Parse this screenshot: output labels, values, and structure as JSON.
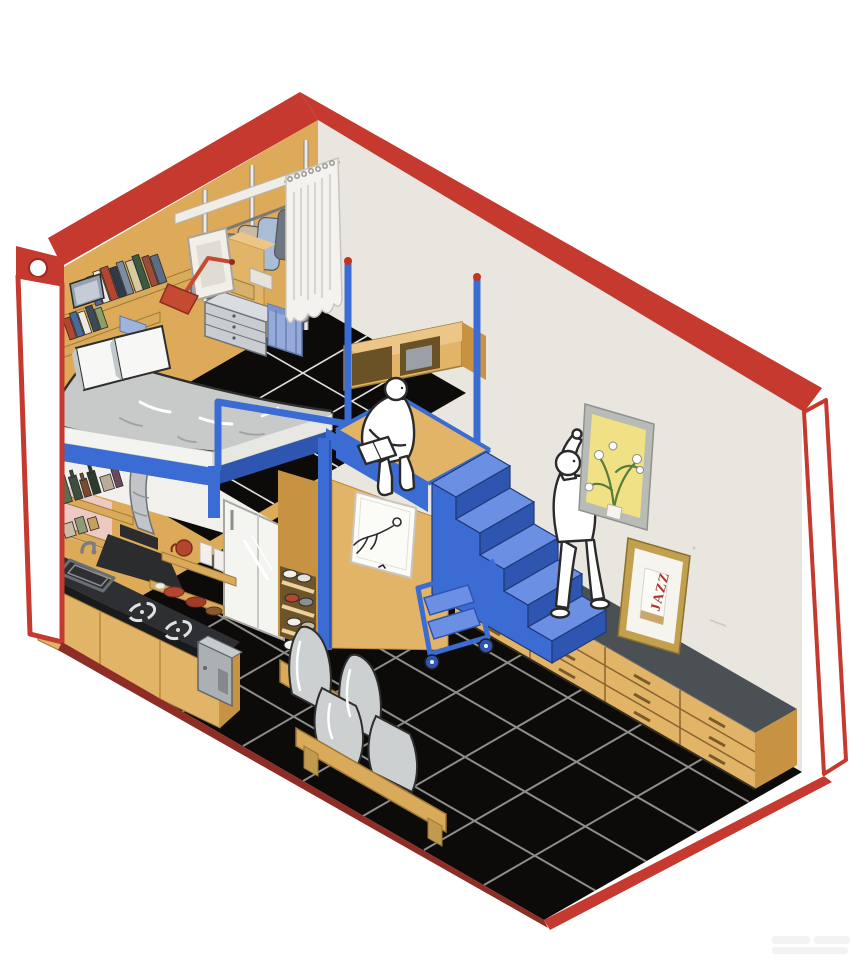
{
  "scene": {
    "description": "Isometric cutaway illustration of a tiny studio apartment framed by a red outline: a loft bed over a kitchenette, a wardrobe corner with hanging clothes and a white curtain, a blue staircase with railing and poles, a long low drawer sideboard along the right wall, a futon sofa on a black tiled floor, one white figure hanging a flower picture and another reading on the loft platform.",
    "visible_text": {
      "jazz_artwork": "JAZZ"
    },
    "palette": {
      "red": "#c5392e",
      "redDark": "#8e2d26",
      "ink": "#2a2a2a",
      "wood": "#e2b467",
      "woodLight": "#ecc687",
      "woodDark": "#c89243",
      "woodShelf": "#d9aa5a",
      "wallTan": "#dcaa58",
      "wallGray": "#e9e6e0",
      "blue": "#3a6cd4",
      "blueDark": "#2e55b0",
      "blueLight": "#6b8fe2",
      "blueSoft": "#95aad8",
      "floorBlack": "#0c0b09",
      "groutDark": "#8d8d8b",
      "groutLight": "#e0e0de",
      "white": "#ffffff",
      "paper": "#fbfbf8",
      "curtain": "#f4f2ee",
      "duvet": "#c8cac9",
      "cushion": "#cdd0d1",
      "pillow": "#f7f7f5",
      "counter": "#2e2f33",
      "steel": "#c2c7cb",
      "kettle": "#aab0b4",
      "fridge": "#f4f4f1",
      "pink": "#eccac3",
      "artYellow": "#f0e184",
      "artGreen": "#567d3e",
      "frameGray": "#b9bcb6",
      "frameGold": "#c2a04e",
      "matWhite": "#f6f4ef",
      "jazzRed": "#b3312c",
      "shoeRed": "#b5452f"
    },
    "objects": [
      {
        "id": "red-frame",
        "label": "red outline frame of the room"
      },
      {
        "id": "left-wall",
        "label": "tan back-left wall"
      },
      {
        "id": "right-wall",
        "label": "light gray back-right wall"
      },
      {
        "id": "tiled-floor",
        "label": "black tiled floor with grout grid"
      },
      {
        "id": "loft-floor",
        "label": "black tiled loft level"
      },
      {
        "id": "wardrobe",
        "label": "open wardrobe with hanging clothes, drawers, baskets and hamper"
      },
      {
        "id": "curtain",
        "label": "white hanging curtain"
      },
      {
        "id": "loft-bed",
        "label": "loft bed with gray duvet and pillows"
      },
      {
        "id": "kitchenette",
        "label": "kitchen counter with sink, burners, hood and shelves"
      },
      {
        "id": "fridge",
        "label": "white refrigerator"
      },
      {
        "id": "closet",
        "label": "under-loft closet with shoe rack and poster"
      },
      {
        "id": "staircase",
        "label": "blue staircase"
      },
      {
        "id": "platform",
        "label": "wooden stair landing with blue rim"
      },
      {
        "id": "railing",
        "label": "blue loft railing and poles with red tips"
      },
      {
        "id": "reading-figure",
        "label": "white figure reading on the loft edge"
      },
      {
        "id": "standing-figure",
        "label": "white figure hanging a picture"
      },
      {
        "id": "flower-artwork",
        "label": "yellow framed flower picture"
      },
      {
        "id": "jazz-artwork",
        "label": "gold framed JAZZ print leaning on sideboard"
      },
      {
        "id": "sideboard",
        "label": "long low drawer sideboard with dark top"
      },
      {
        "id": "sofa",
        "label": "wooden futon sofa with gray cushions"
      },
      {
        "id": "cart",
        "label": "blue rolling step cart"
      },
      {
        "id": "watermark",
        "label": "faint watermark in bottom-right corner"
      }
    ]
  }
}
